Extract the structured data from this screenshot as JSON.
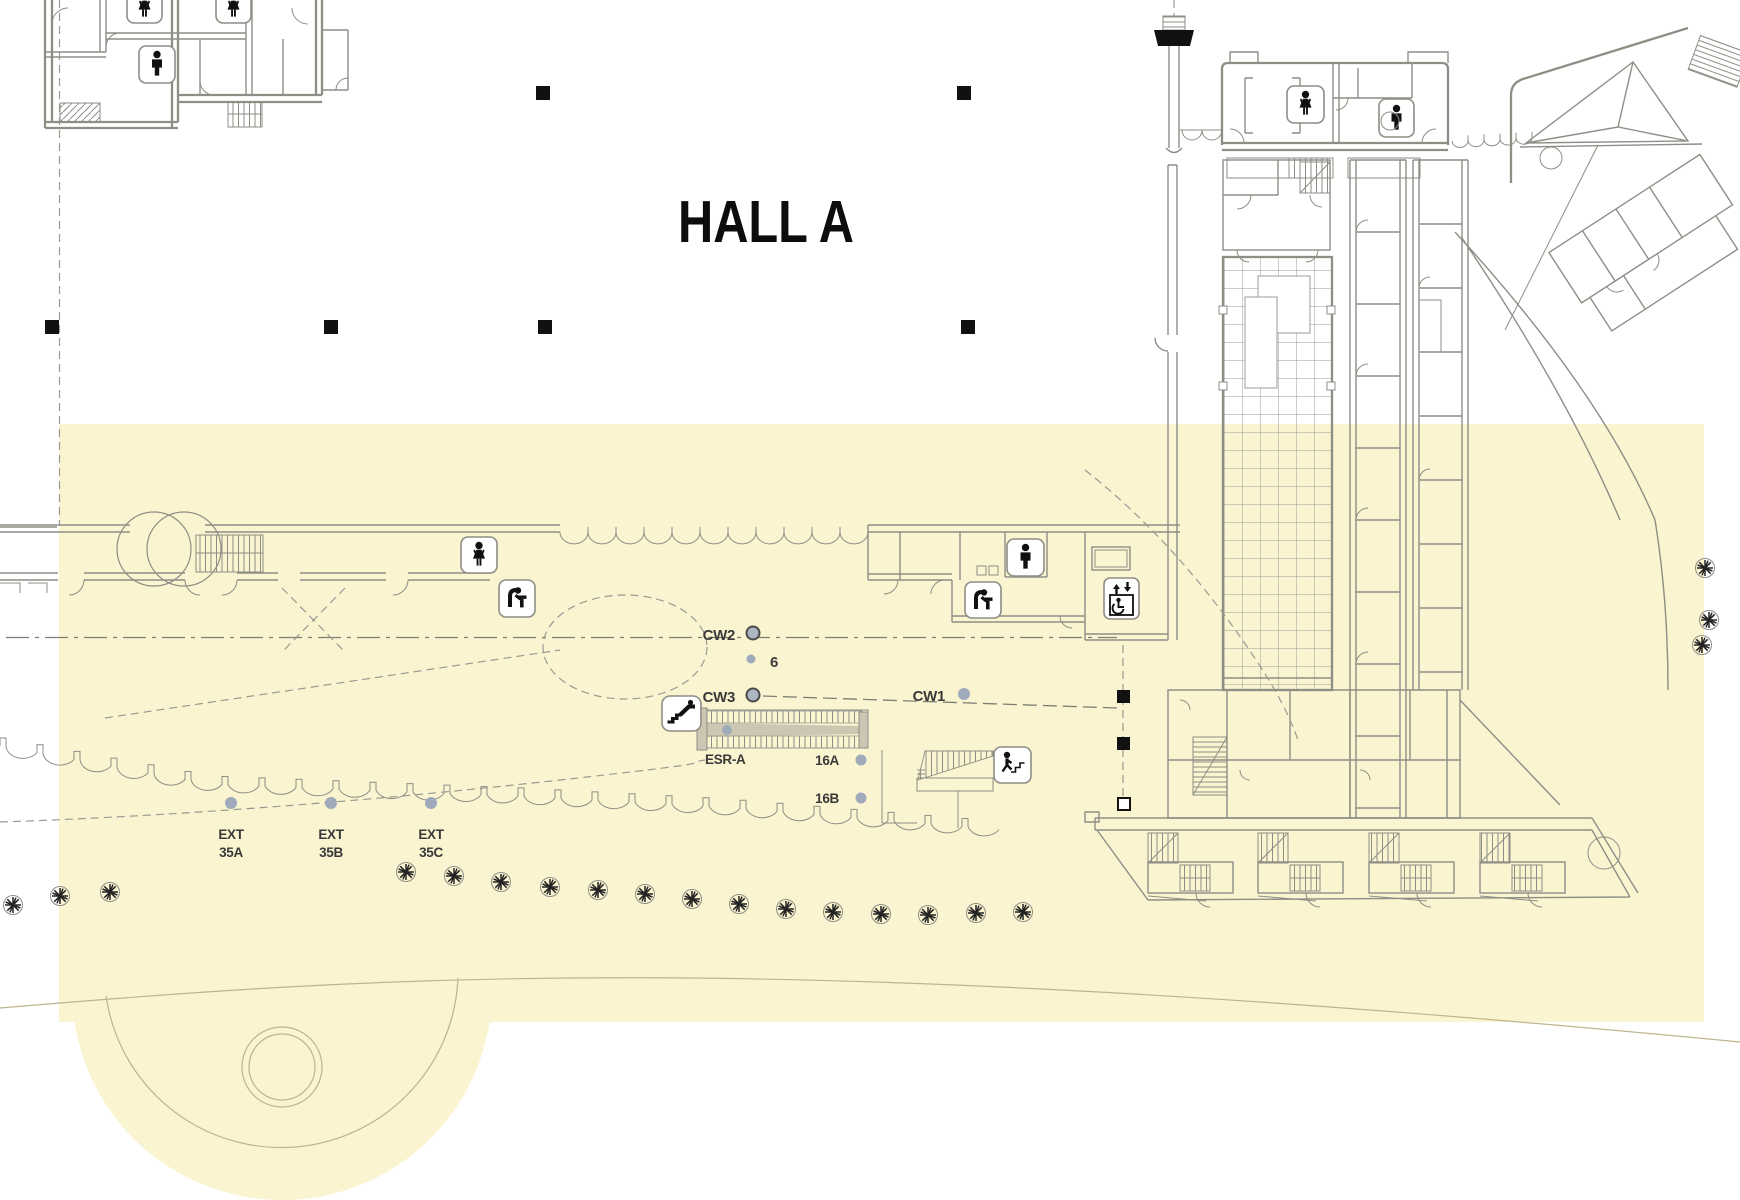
{
  "colors": {
    "highlight": "#FAF4D0",
    "wall_line": "#8E8E86",
    "glyph_black": "#111111",
    "label_text": "#3A3A3A",
    "title_text": "#0D0D0D",
    "dot_fill": "#9FAABA",
    "dot_ring_fill": "#AEB6C2",
    "dot_ring_stroke": "#4A4A4A",
    "site_line": "#BCB58E"
  },
  "title": {
    "hall": "HALL A"
  },
  "callouts": {
    "cw2": "CW2",
    "cw3": "CW3",
    "cw1": "CW1",
    "grid6": "6",
    "esr": "ESR-A",
    "s16a": "16A",
    "s16b": "16B",
    "ext_a1": "EXT",
    "ext_a2": "35A",
    "ext_b1": "EXT",
    "ext_b2": "35B",
    "ext_c1": "EXT",
    "ext_c2": "35C"
  }
}
